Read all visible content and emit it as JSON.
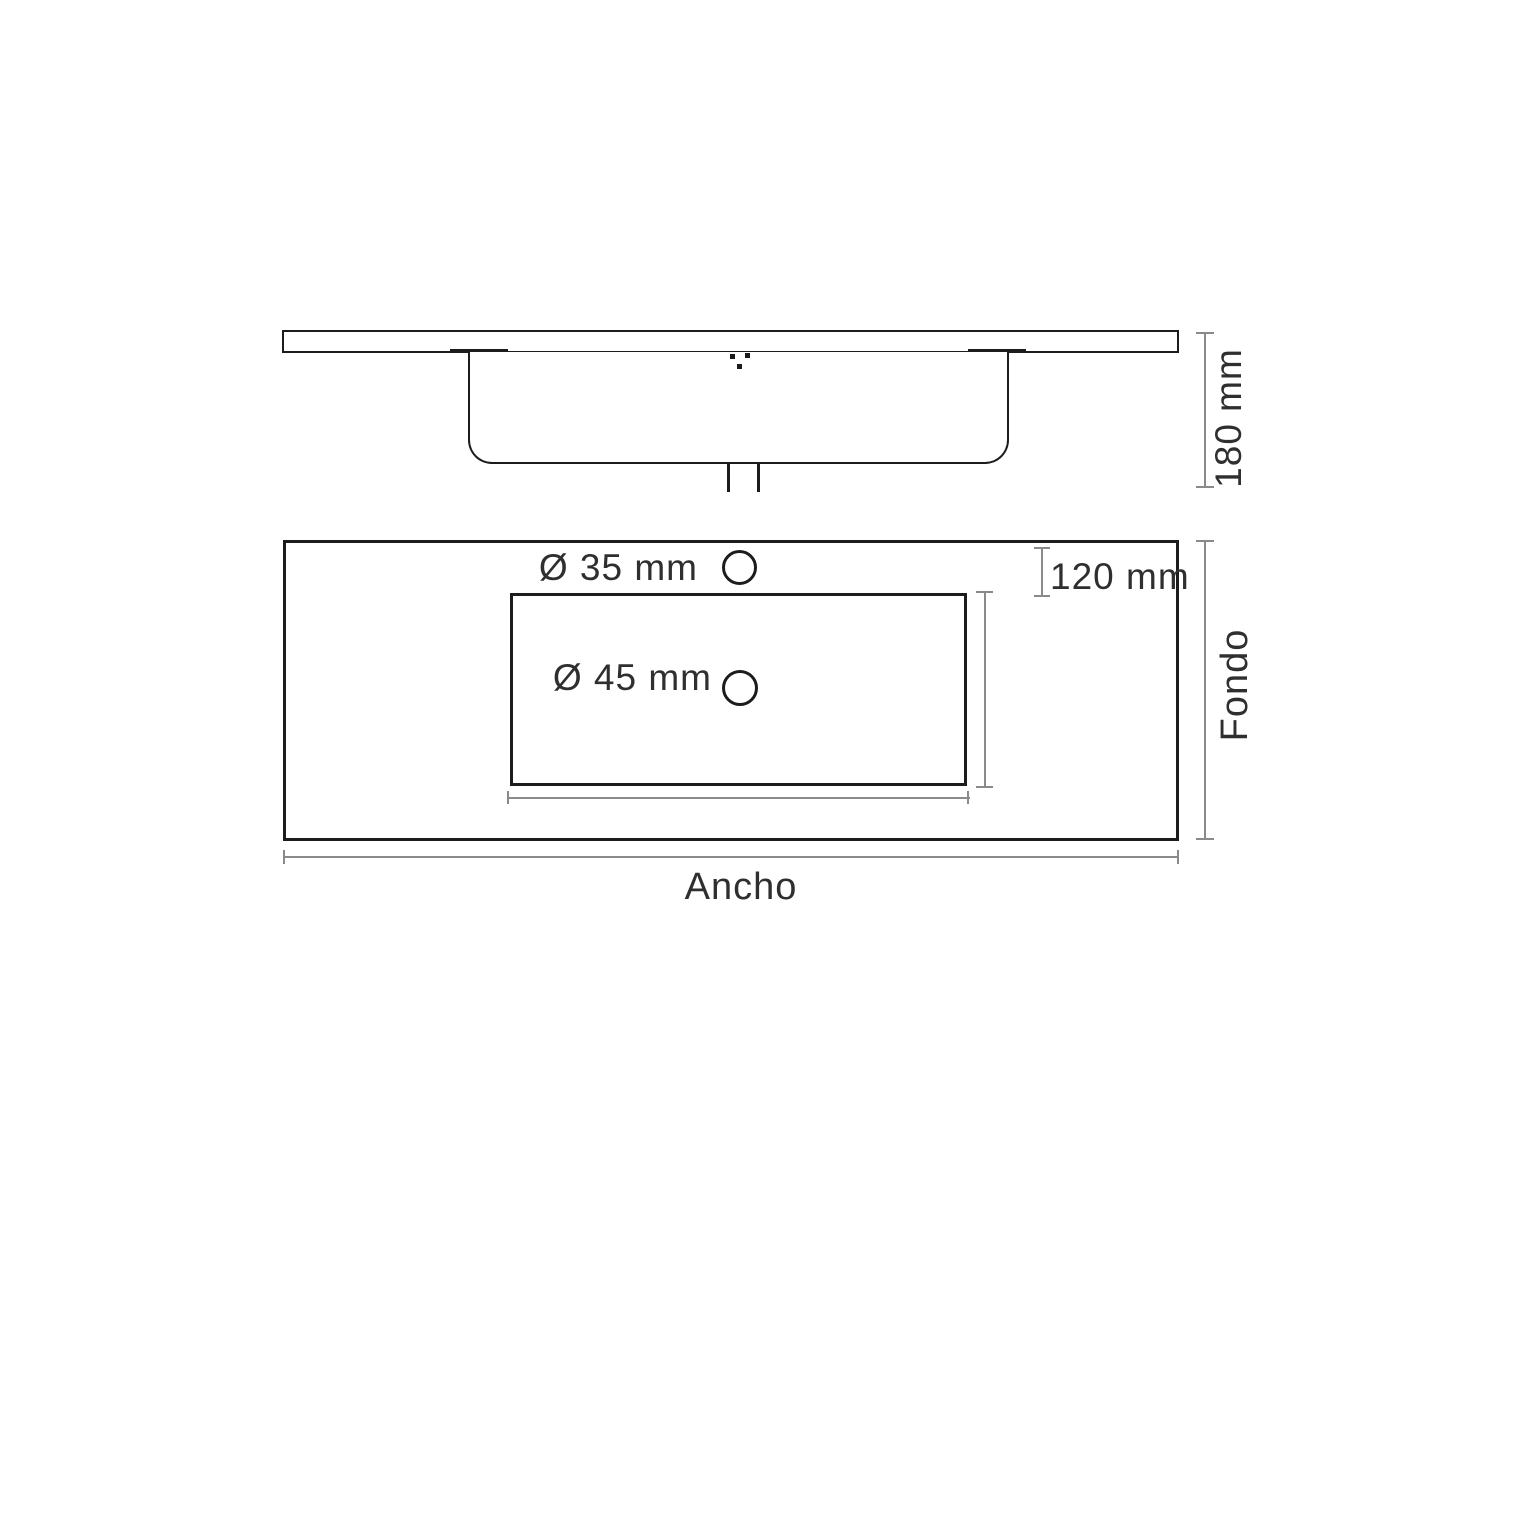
{
  "drawing": {
    "type": "washbasin-technical-drawing",
    "elevation_view": {
      "height_dim_label": "180 mm"
    },
    "plan_view": {
      "faucet_hole_label": "Ø 35 mm",
      "drain_hole_label": "Ø 45 mm",
      "faucet_offset_label": "120 mm",
      "depth_axis_label": "Fondo",
      "width_axis_label": "Ancho"
    },
    "colors": {
      "outline": "#1c1c1c",
      "dimension_line": "#8a8a8a",
      "text": "#2f2f2f",
      "background": "#ffffff"
    }
  }
}
